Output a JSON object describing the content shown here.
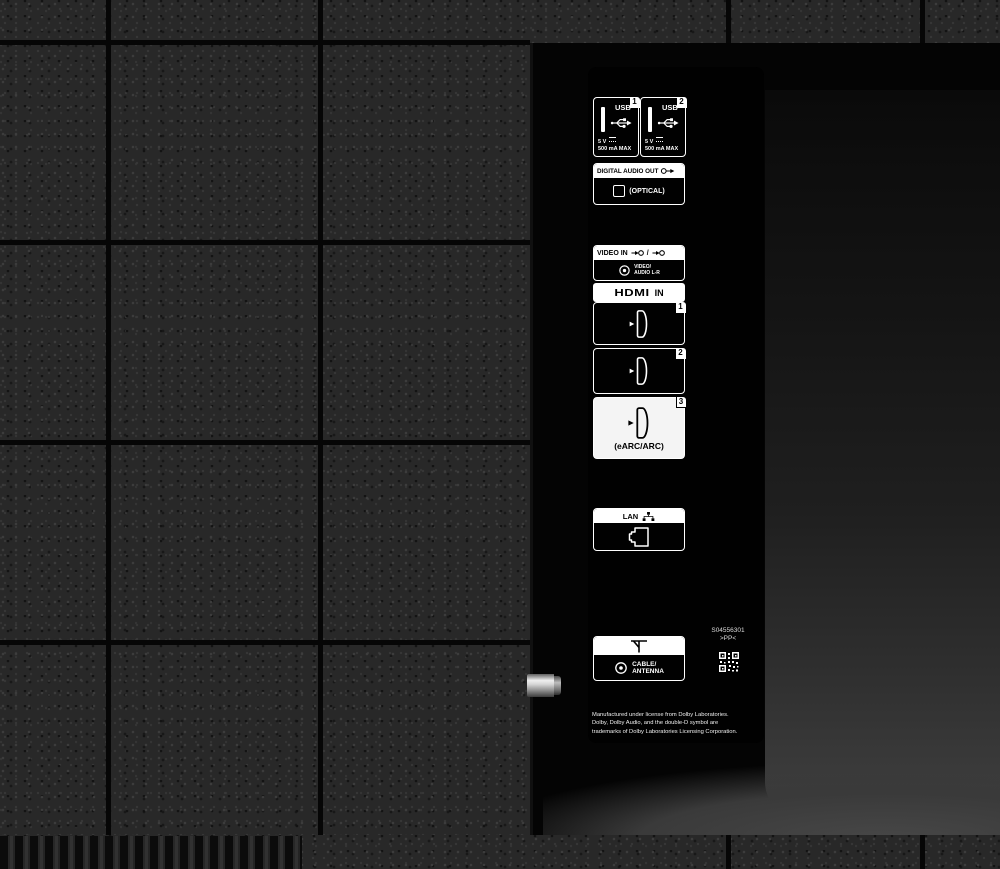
{
  "scene": {
    "description": "Rear connection panel of a television"
  },
  "ports": {
    "usb": [
      {
        "number": "1",
        "label": "USB",
        "power_line1": "5 V",
        "power_line2": "500 mA MAX"
      },
      {
        "number": "2",
        "label": "USB",
        "power_line1": "5 V",
        "power_line2": "500 mA MAX"
      }
    ],
    "digital_audio_out": {
      "label": "DIGITAL AUDIO OUT",
      "type_label": "(OPTICAL)"
    },
    "video_in": {
      "label": "VIDEO IN",
      "separator": "/",
      "jack_line1": "VIDEO/",
      "jack_line2": "AUDIO L-R"
    },
    "hdmi": {
      "logo": "HDMI",
      "suffix": "IN",
      "ports": [
        {
          "number": "1"
        },
        {
          "number": "2"
        },
        {
          "number": "3",
          "sub_label": "(eARC/ARC)"
        }
      ]
    },
    "lan": {
      "label": "LAN"
    },
    "cable_antenna": {
      "line1": "CABLE/",
      "line2": "ANTENNA"
    }
  },
  "markings": {
    "part_number": "S04556301",
    "resin_code": ">PP<",
    "dolby_line1": "Manufactured under license from Dolby Laboratories.",
    "dolby_line2": "Dolby, Dolby Audio, and the double-D symbol are",
    "dolby_line3": "trademarks of Dolby Laboratories Licensing Corporation."
  },
  "colors": {
    "chassis_texture": "#282828",
    "grid_line": "#060606",
    "recess": "#040404",
    "label_panel": "#010101",
    "print": "#ffffff",
    "earc_port_bg": "#f4f4f4",
    "metal_stub": "#d5d5d5"
  }
}
